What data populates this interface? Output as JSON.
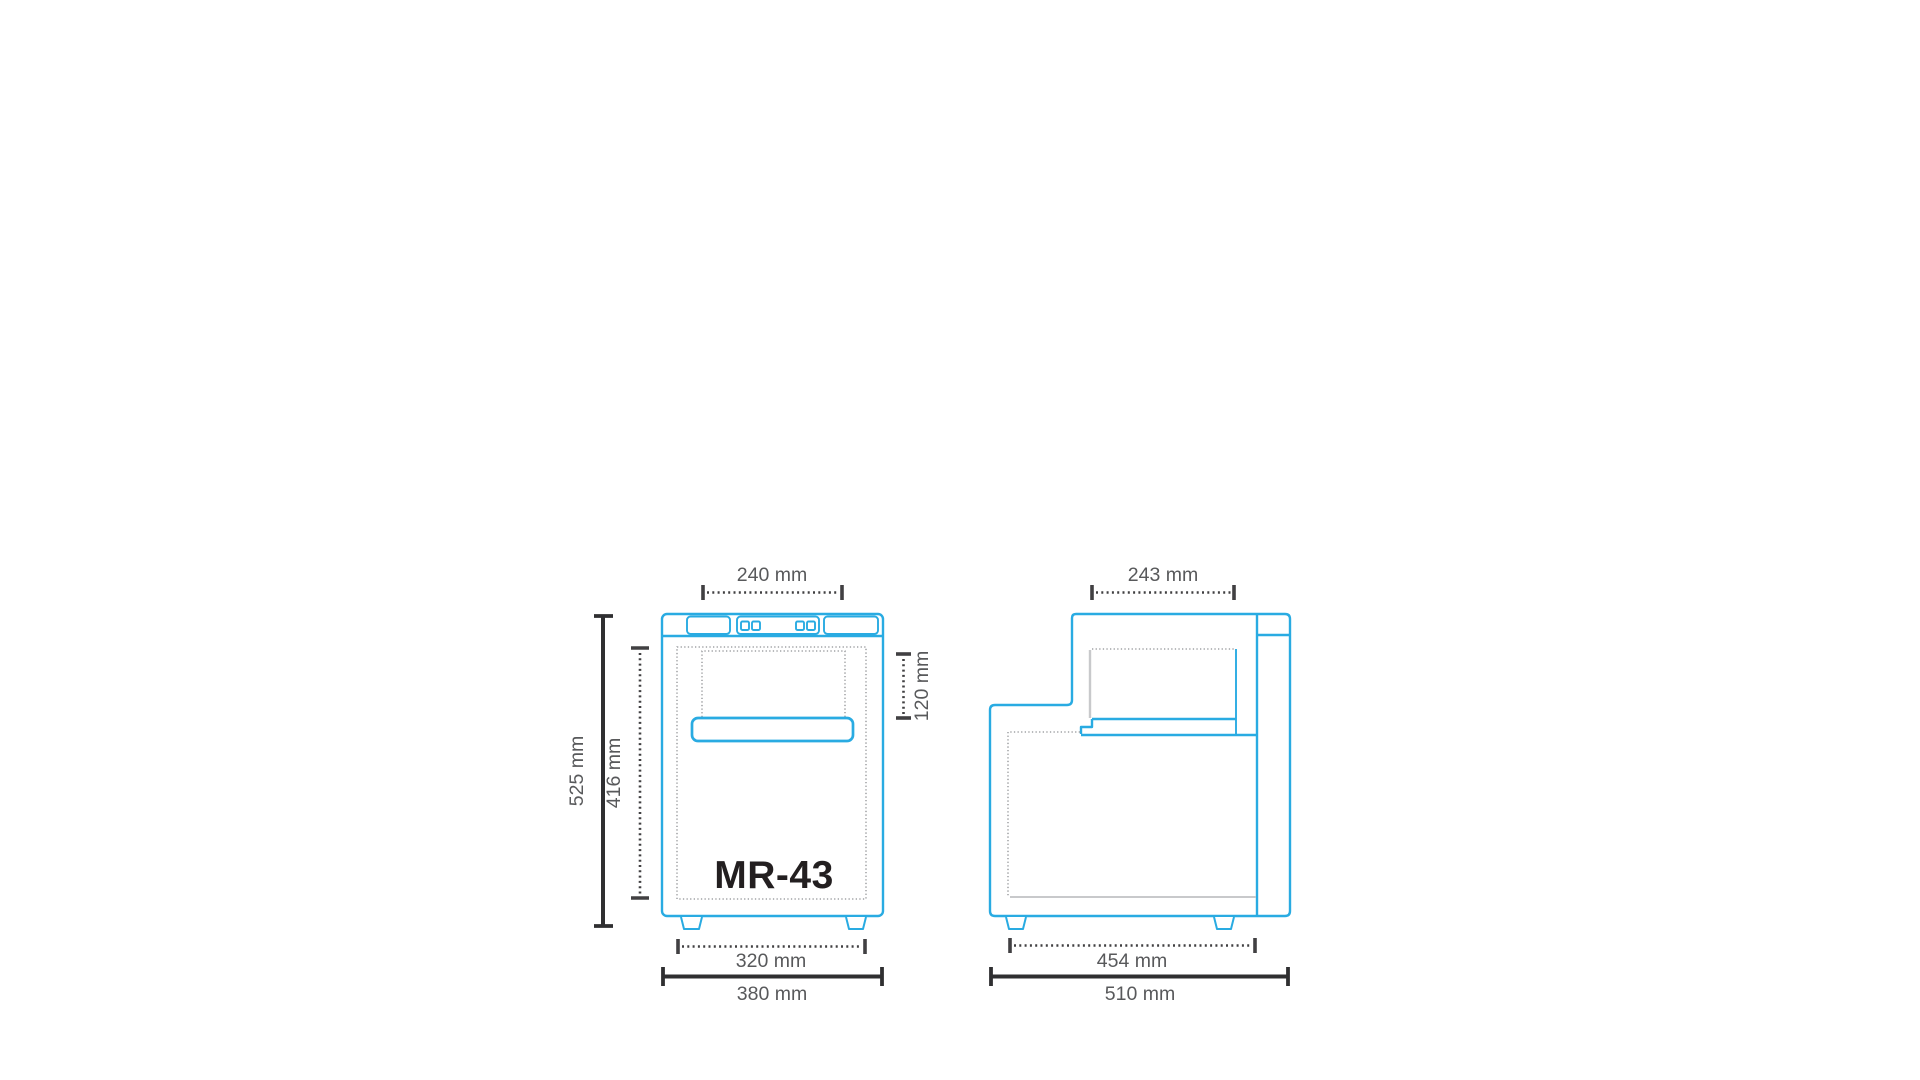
{
  "diagram": {
    "model_label": "MR-43",
    "front_view": {
      "dim_top_width": "240 mm",
      "dim_overall_height": "525 mm",
      "dim_interior_height": "416 mm",
      "dim_top_recess": "120 mm",
      "dim_feet_width": "320 mm",
      "dim_overall_width": "380 mm"
    },
    "side_view": {
      "dim_top_depth": "243 mm",
      "dim_feet_depth": "454 mm",
      "dim_overall_depth": "510 mm"
    },
    "colors": {
      "outline_blue": "#29abe2",
      "dimension_text_gray": "#58595b",
      "dimension_line_dark": "#2f2f31",
      "part_dotted_gray": "#8e9093",
      "liner_gray": "#c8c9cb",
      "model_text_dark": "#231f20",
      "background": "#ffffff"
    }
  }
}
